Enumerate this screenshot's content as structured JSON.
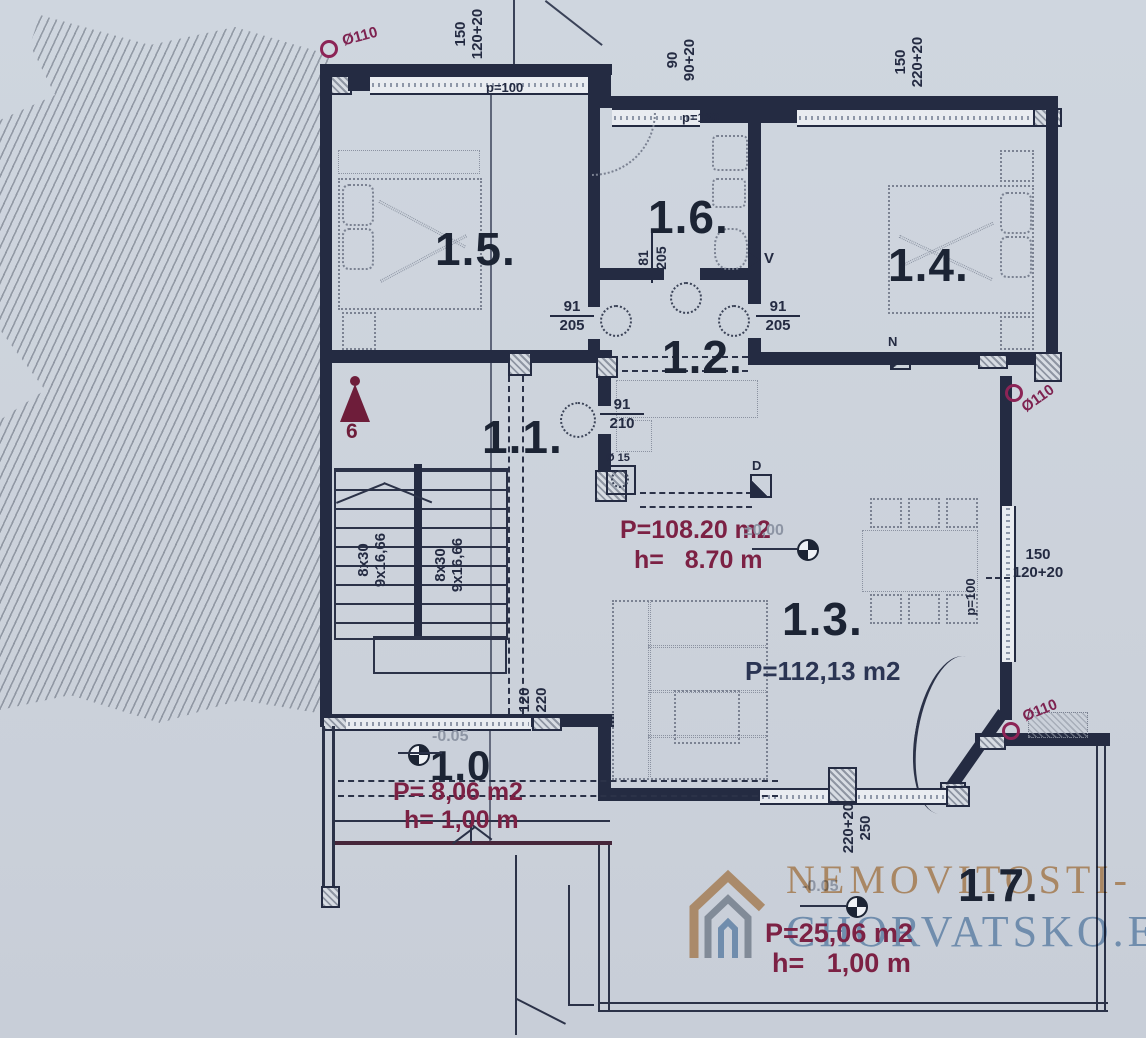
{
  "watermark": {
    "line1": "NEMOVITOSTI-",
    "line2": "CHORVATSKO.EU"
  },
  "rooms": {
    "r10": "1.0",
    "r11": "1.1.",
    "r12": "1.2.",
    "r13": "1.3.",
    "r14": "1.4.",
    "r15": "1.5.",
    "r16": "1.6.",
    "r17": "1.7."
  },
  "annotations": {
    "r13_area_marked": "P=108.20 m2",
    "r13_height_marked": "h=   8.70 m",
    "r13_level": "±0,00",
    "r13_area": "P=112,13 m2",
    "r10_area": "P= 8,06 m2",
    "r10_height": "h= 1,00 m",
    "r10_level": "-0.05",
    "r17_area": "P=25,06 m2",
    "r17_height": "h=   1,00 m",
    "r17_level": "-0.05",
    "section_mark": "6"
  },
  "dimensions": {
    "top_left": {
      "a": "150",
      "b": "120+20"
    },
    "top_mid": {
      "a": "90",
      "b": "90+20"
    },
    "top_right": {
      "a": "150",
      "b": "220+20"
    },
    "right": {
      "a": "150",
      "b": "120+20"
    },
    "terrace_door": {
      "a": "220+20",
      "b": "250"
    },
    "hall_door": {
      "a": "120",
      "b": "220"
    },
    "parapet_top": "p=100",
    "parapet_bath": "p=130",
    "parapet_right": "p=100"
  },
  "doors": {
    "d15": {
      "num": "91",
      "den": "205"
    },
    "d16": {
      "num": "81",
      "den": "205"
    },
    "d14": {
      "num": "91",
      "den": "205"
    },
    "d11": {
      "num": "91",
      "den": "210"
    }
  },
  "stairs": {
    "flight1": {
      "a": "8x30",
      "b": "9x16,66"
    },
    "flight2": {
      "a": "8x30",
      "b": "9x16,66"
    }
  },
  "markers": {
    "drain_top_left": "Ø110",
    "drain_right": "Ø110",
    "drain_bottom_right": "Ø110",
    "floor_drain": "Ø 15",
    "vent": "V",
    "downpipe": "D",
    "north": "N"
  },
  "colors": {
    "paper": "#ccd2db",
    "wall": "#242b42",
    "accent_maroon": "#7c2144",
    "accent_magenta": "#8c2456",
    "watermark_orange": "#c98a4a",
    "watermark_blue": "#628fb8"
  }
}
